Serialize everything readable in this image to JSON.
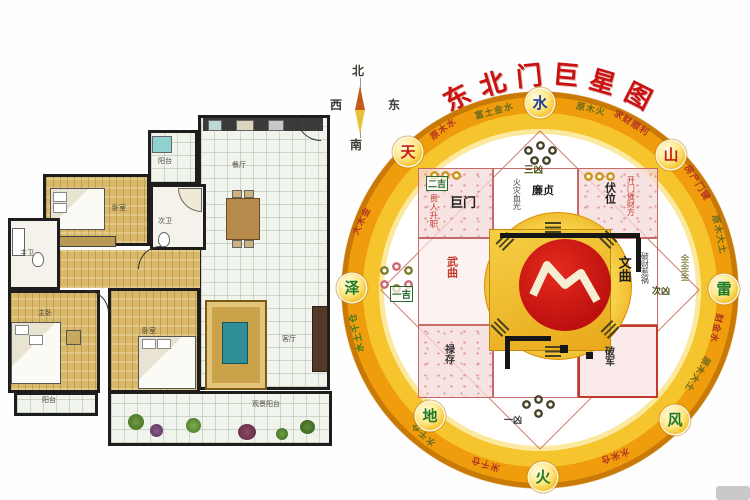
{
  "title": {
    "text": "东北门巨星图",
    "chars": [
      "东",
      "北",
      "门",
      "巨",
      "星",
      "图"
    ]
  },
  "mini_compass": {
    "north": "北",
    "south": "南",
    "east": "东",
    "west": "西"
  },
  "floor_plan": {
    "rooms": [
      {
        "label": "阳台"
      },
      {
        "label": "餐厅"
      },
      {
        "label": "卧室"
      },
      {
        "label": "次卫"
      },
      {
        "label": "主卫"
      },
      {
        "label": "主卧"
      },
      {
        "label": "卧室"
      },
      {
        "label": "客厅"
      },
      {
        "label": "阳台"
      },
      {
        "label": "观景阳台"
      }
    ]
  },
  "compass": {
    "badges": [
      {
        "char": "水"
      },
      {
        "char": "天"
      },
      {
        "char": "山"
      },
      {
        "char": "泽"
      },
      {
        "char": "雷"
      },
      {
        "char": "地"
      },
      {
        "char": "风"
      },
      {
        "char": "火"
      }
    ],
    "ring_texts": [
      "原木水",
      "富土金水",
      "原木火",
      "求财顺利",
      "房产门键",
      "原木大土",
      "财金水",
      "原木大土",
      "水米仓",
      "米千仓",
      "水千仓",
      "大木金",
      "水土千仓"
    ],
    "stars": {
      "jumen": {
        "rating": "二吉",
        "name": "巨门",
        "note": "贵人升职"
      },
      "lianzhen": {
        "rating": "三凶",
        "name": "廉贞",
        "note": "火灾血光"
      },
      "fuwei": {
        "name": "伏位",
        "note": "开门催财方"
      },
      "wenqu": {
        "name": "文曲",
        "note": "破财惹祸",
        "metals": "金金金",
        "rating": "次凶"
      },
      "wuqu": {
        "name": "武曲"
      },
      "yiji": {
        "rating": "一吉"
      },
      "lucun": {
        "name": "禄存"
      },
      "pojun": {
        "name": "破军"
      },
      "bottom_rating": "一凶"
    }
  },
  "colors": {
    "ring_gold": "#f6c52e",
    "ring_orange": "#ef9d0d",
    "center_red": "#b80d0d",
    "title_red": "#cc1111",
    "pink_cell": "#f6d9d9",
    "wood_floor": "#d9b86a"
  }
}
